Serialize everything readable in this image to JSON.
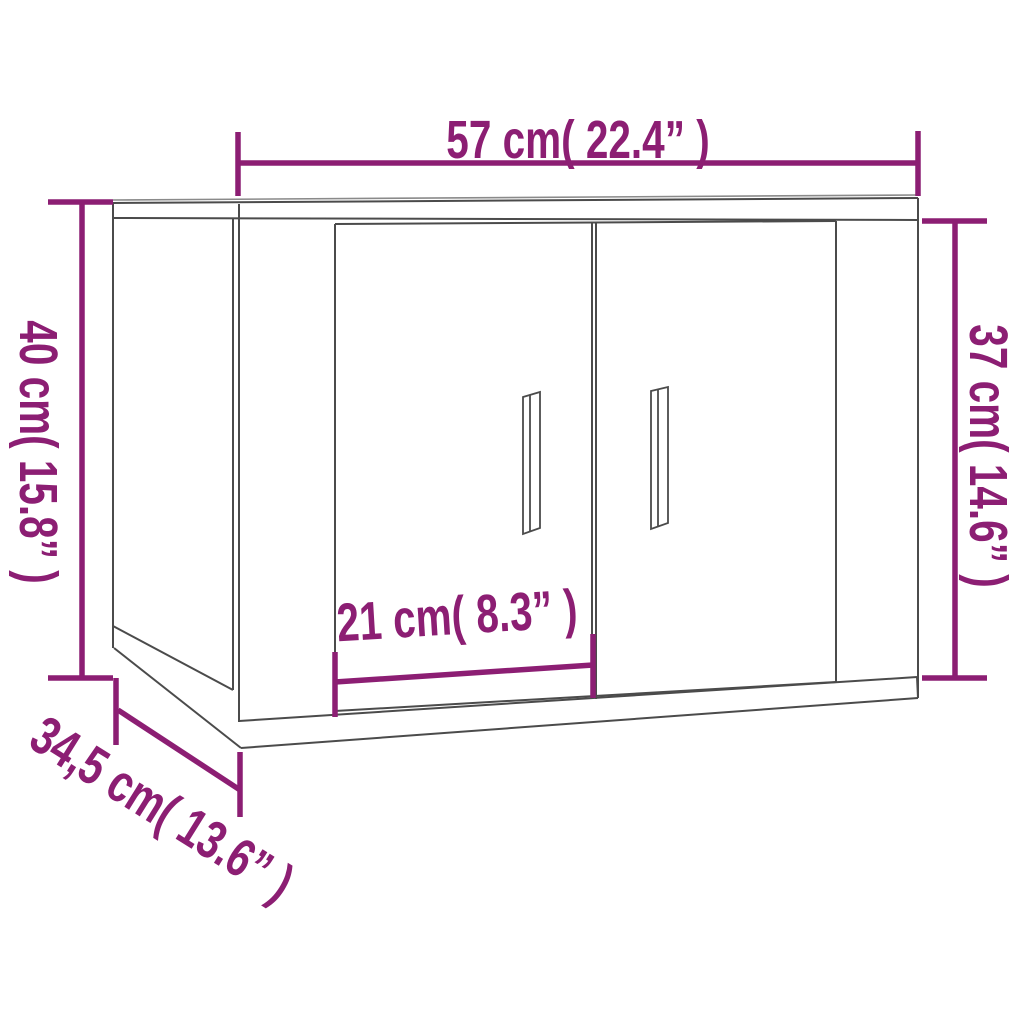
{
  "figure": {
    "type": "furniture-dimension-diagram",
    "subject": "wall-mounted cabinet with two doors"
  },
  "colors": {
    "dimension": "#8C1E73",
    "outline": "#4b4b4b",
    "outline_light": "#8a8a8a",
    "background": "#ffffff"
  },
  "dimensions": {
    "width": {
      "label": "57 cm( 22.4” )",
      "cm": 57,
      "inches": 22.4
    },
    "height_left": {
      "label": "40 cm( 15.8” )",
      "cm": 40,
      "inches": 15.8
    },
    "height_right": {
      "label": "37 cm( 14.6” )",
      "cm": 37,
      "inches": 14.6
    },
    "door_width": {
      "label": "21 cm( 8.3” )",
      "cm": 21,
      "inches": 8.3
    },
    "depth": {
      "label": "34,5 cm( 13.6” )",
      "cm": 34.5,
      "inches": 13.6
    }
  }
}
